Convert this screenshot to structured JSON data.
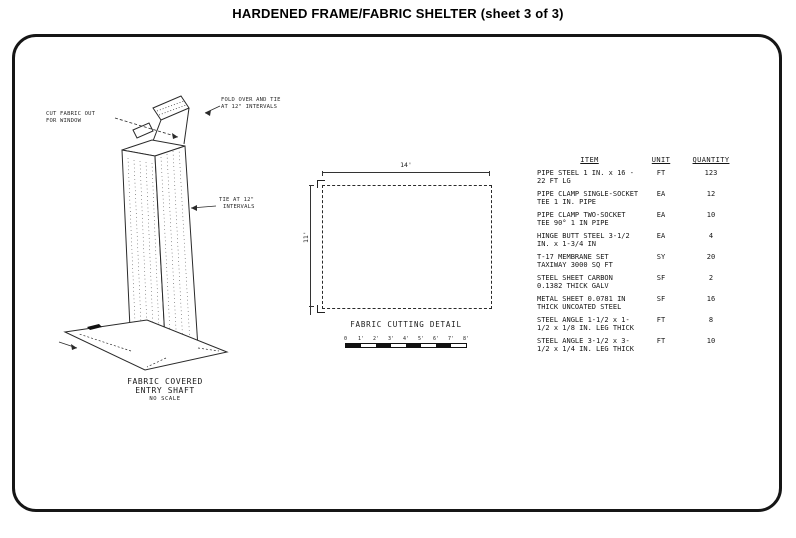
{
  "title": "HARDENED FRAME/FABRIC SHELTER (sheet 3 of 3)",
  "entry_shaft": {
    "callout_cut_line1": "CUT FABRIC OUT",
    "callout_cut_line2": "FOR WINDOW",
    "callout_fold_line1": "FOLD OVER AND TIE",
    "callout_fold_line2": "AT 12\" INTERVALS",
    "callout_tie_line1": "TIE AT 12\"",
    "callout_tie_line2": "INTERVALS",
    "caption_line1": "FABRIC COVERED",
    "caption_line2": "ENTRY SHAFT",
    "caption_line3": "NO SCALE"
  },
  "cutting_detail": {
    "width_dim": "14'",
    "height_dim": "11'",
    "caption": "FABRIC CUTTING DETAIL",
    "scale_ticks": [
      "0",
      "1'",
      "2'",
      "3'",
      "4'",
      "5'",
      "6'",
      "7'",
      "8'"
    ]
  },
  "table": {
    "header_item": "ITEM",
    "header_unit": "UNIT",
    "header_quantity": "QUANTITY",
    "rows": [
      {
        "item": "PIPE STEEL 1 IN. x 16 - 22 FT LG",
        "unit": "FT",
        "qty": "123"
      },
      {
        "item": "PIPE CLAMP SINGLE-SOCKET TEE 1 IN. PIPE",
        "unit": "EA",
        "qty": "12"
      },
      {
        "item": "PIPE CLAMP TWO-SOCKET TEE 90° 1 IN PIPE",
        "unit": "EA",
        "qty": "10"
      },
      {
        "item": "HINGE BUTT STEEL 3-1/2 IN. x 1-3/4 IN",
        "unit": "EA",
        "qty": "4"
      },
      {
        "item": "T-17 MEMBRANE SET TAXIWAY 3000 SQ FT",
        "unit": "SY",
        "qty": "20"
      },
      {
        "item": "STEEL SHEET CARBON 0.1382 THICK GALV",
        "unit": "SF",
        "qty": "2"
      },
      {
        "item": "METAL SHEET 0.0781 IN THICK UNCOATED STEEL",
        "unit": "SF",
        "qty": "16"
      },
      {
        "item": "STEEL ANGLE 1-1/2 x 1-1/2 x 1/8 IN. LEG THICK",
        "unit": "FT",
        "qty": "8"
      },
      {
        "item": "STEEL ANGLE 3-1/2 x 3-1/2 x 1/4 IN. LEG THICK",
        "unit": "FT",
        "qty": "10"
      }
    ]
  },
  "colors": {
    "ink": "#1c1c1c",
    "paper": "#ffffff"
  }
}
